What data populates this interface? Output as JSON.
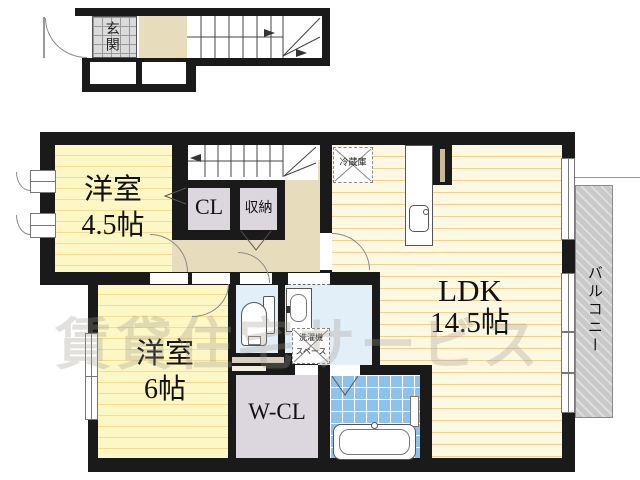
{
  "plan": {
    "entrance": "玄関",
    "room_45": {
      "name": "洋室",
      "size": "4.5帖"
    },
    "room_6": {
      "name": "洋室",
      "size": "6帖"
    },
    "ldk": {
      "name": "LDK",
      "size": "14.5帖"
    },
    "closet": "CL",
    "storage": "収納",
    "walk_in_closet": "W-CL",
    "balcony": "バルコニー",
    "refrigerator": "冷蔵庫",
    "washer_space": {
      "line1": "洗濯機",
      "line2": "スペース"
    }
  },
  "watermark": "賃貸住宅サービス",
  "colors": {
    "wall": "#1a1a1a",
    "room_yellow": "#fdf6c5",
    "room_stripe": "#f3dd92",
    "ldk_yellow": "#fdf8e2",
    "ldk_stripe": "#f0cf90",
    "hallway_beige": "#e7ddbd",
    "closet_lavender": "#dcd7df",
    "sanitary_blue": "#e2eef8",
    "bath_tile_blue": "#8fc2ea",
    "balcony_gray": "#cbcbcb",
    "entrance_tile_gray": "#dbdbdb"
  }
}
